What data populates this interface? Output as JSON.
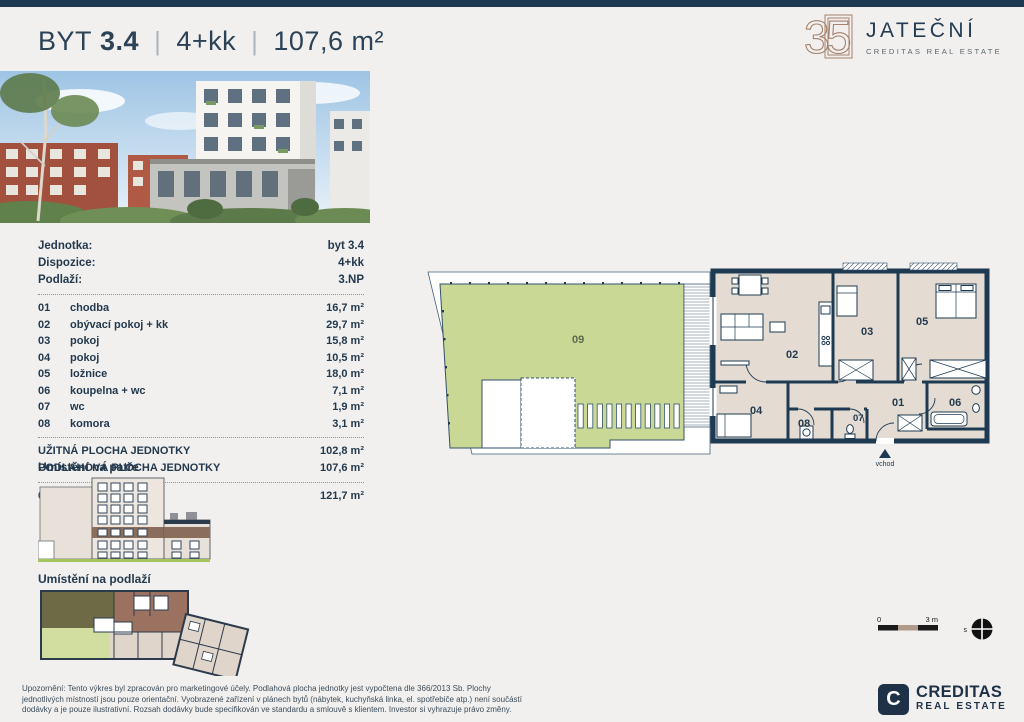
{
  "colors": {
    "navy": "#1e3a52",
    "text_navy": "#23394e",
    "room_beige": "#e4dcd3",
    "garden_green": "#c9d894",
    "logo_brown": "#a5826d",
    "highlight_brown": "#8a6e5b",
    "ground_green": "#a3c45e"
  },
  "header": {
    "title_byt": "BYT",
    "title_num": "3.4",
    "sep": "|",
    "disposition": "4+kk",
    "area": "107,6 m²"
  },
  "brand": {
    "emblem": "35",
    "name": "JATEČNÍ",
    "subtitle": "CREDITAS REAL ESTATE"
  },
  "unit_info": {
    "rows": [
      {
        "label": "Jednotka:",
        "value": "byt 3.4"
      },
      {
        "label": "Dispozice:",
        "value": "4+kk"
      },
      {
        "label": "Podlaží:",
        "value": "3.NP"
      }
    ]
  },
  "rooms": [
    {
      "num": "01",
      "name": "chodba",
      "area": "16,7 m²"
    },
    {
      "num": "02",
      "name": "obývací pokoj + kk",
      "area": "29,7 m²"
    },
    {
      "num": "03",
      "name": "pokoj",
      "area": "15,8 m²"
    },
    {
      "num": "04",
      "name": "pokoj",
      "area": "10,5 m²"
    },
    {
      "num": "05",
      "name": "ložnice",
      "area": "18,0 m²"
    },
    {
      "num": "06",
      "name": "koupelna + wc",
      "area": "7,1 m²"
    },
    {
      "num": "07",
      "name": "wc",
      "area": "1,9 m²"
    },
    {
      "num": "08",
      "name": "komora",
      "area": "3,1 m²"
    }
  ],
  "summary": [
    {
      "label": "UŽITNÁ PLOCHA JEDNOTKY",
      "value": "102,8 m²"
    },
    {
      "label": "PODLAHOVÁ PLOCHA JEDNOTKY",
      "value": "107,6 m²"
    }
  ],
  "garden": {
    "num": "09",
    "name": "zahrada",
    "area": "121,7 m²"
  },
  "sections": {
    "floor_location": "Umístění na patře",
    "level_location": "Umístění na podlaží"
  },
  "plan": {
    "labels": {
      "r01": "01",
      "r02": "02",
      "r03": "03",
      "r04": "04",
      "r05": "05",
      "r06": "06",
      "r07": "07",
      "r08": "08",
      "r09": "09"
    },
    "entrance": "vchod",
    "scale_start": "0",
    "scale_end": "3 m",
    "compass": "s"
  },
  "footer": {
    "disclaimer": "Upozornění: Tento výkres byl zpracován pro marketingové účely. Podlahová plocha jednotky jest vypočtena dle 366/2013 Sb. Plochy jednotlivých místností jsou pouze orientační. Vyobrazené zařízení v plánech bytů (nábytek, kuchyňská linka, el. spotřebiče atp.) není součástí dodávky a je pouze ilustrativní. Rozsah dodávky bude specifikován ve standardu a smlouvě s klientem. Investor si vyhrazuje právo změny.",
    "logo_letter": "C",
    "logo_name": "CREDITAS",
    "logo_sub": "REAL ESTATE"
  }
}
